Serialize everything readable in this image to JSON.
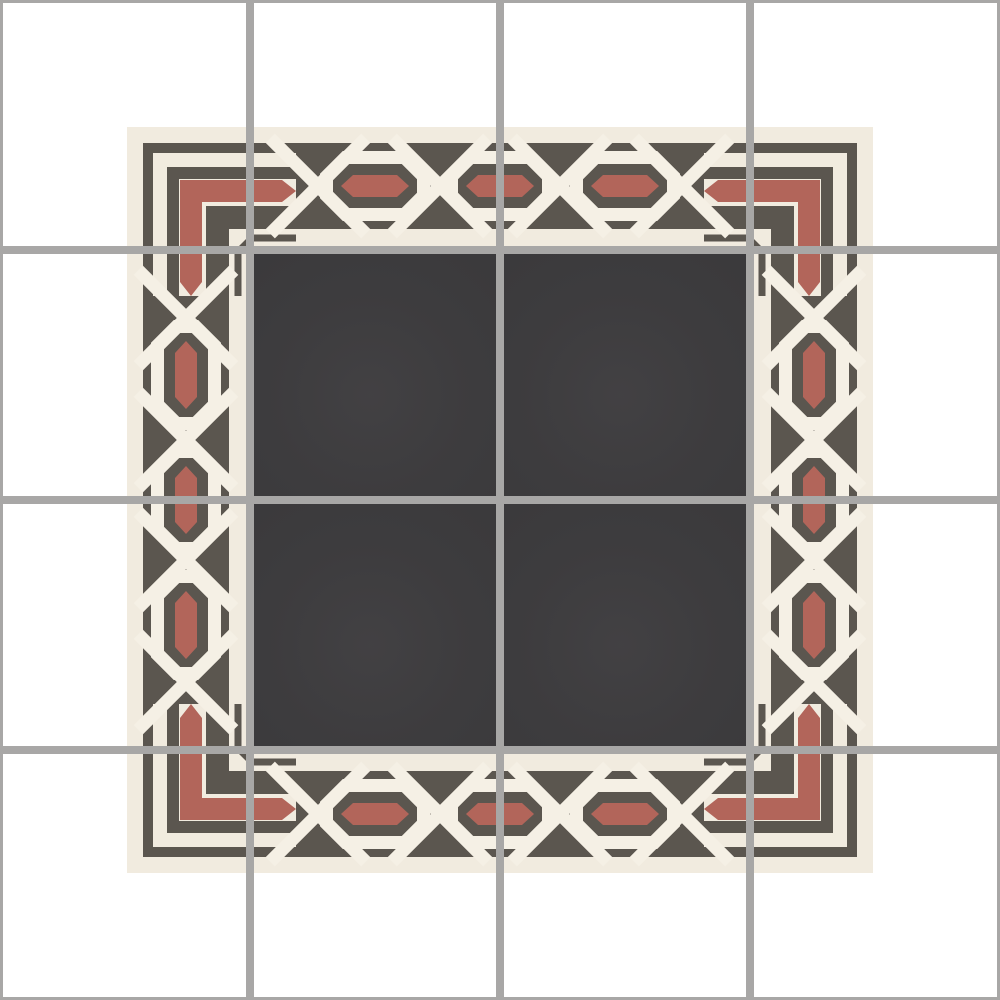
{
  "image": {
    "description": "Encaustic cement tile layout preview: 4x4 tile grid with grout, chain-link guilloche border pattern framing four charcoal field tiles",
    "background": "#ffffff"
  },
  "colors": {
    "grout": "#a8a7a6",
    "cream_field": "#f1ebdf",
    "link_cream": "#f5f0e5",
    "band_dark": "#5b564f",
    "red": "#b2655a",
    "charcoal_field": "#3b3a3c",
    "sheen": "#4b494c"
  },
  "grid": {
    "rows": 4,
    "cols": 4,
    "tile_size": 250,
    "interior_line_positions": [
      246,
      496,
      746
    ],
    "interior_line_width": 8,
    "edge_line_width": 3
  },
  "panel": {
    "x1": 127,
    "y1": 127,
    "x2": 873,
    "y2": 873
  },
  "border": {
    "outer_edge": 143,
    "thickness": 86,
    "corner_end": 296,
    "stripes": [
      {
        "offset": 0,
        "width": 10
      },
      {
        "offset": 24,
        "width": 12
      }
    ],
    "red_stripe": {
      "offset": 37,
      "width": 22,
      "tip_start": 282
    },
    "inner_stripe": {
      "offset": 63,
      "width": 23
    },
    "ring_centers": [
      375,
      500,
      625
    ],
    "cross_centers": [
      318,
      440,
      560,
      682
    ],
    "ring": {
      "length": 97,
      "height": 57,
      "chamfer": 19,
      "stroke": 13
    },
    "red_link": {
      "length": 68,
      "height": 22,
      "tip": 12
    },
    "cross_band": {
      "length": 135,
      "width": 13
    }
  },
  "inner_bracket": {
    "line": 238,
    "chamfer": 252,
    "arm_end": 296,
    "stroke": 7
  },
  "field": {
    "from": 250,
    "to": 750
  }
}
